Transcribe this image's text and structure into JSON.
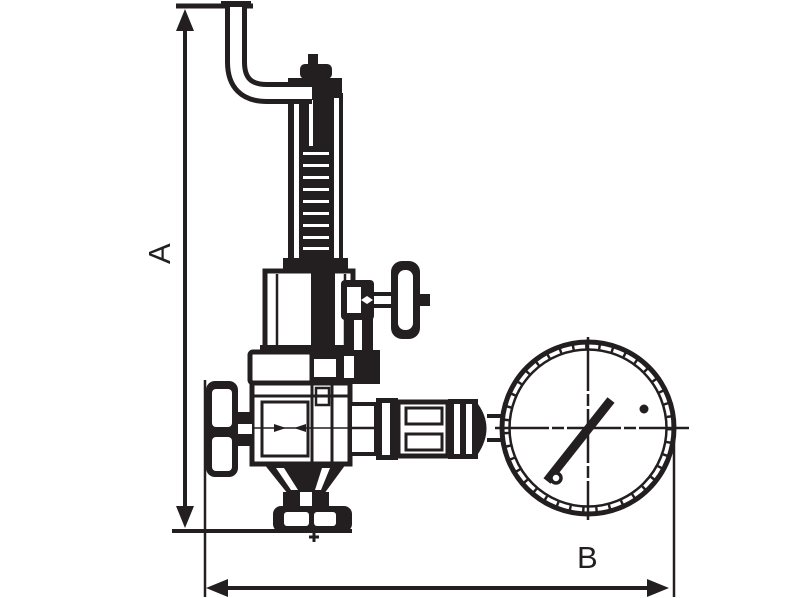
{
  "meta": {
    "background": "#ffffff",
    "line_color": "#231f20",
    "drawing_kind": "dimensioned technical line drawing of a safety/reducing valve with pressure gauge"
  },
  "dimensions": {
    "vertical_label": "A",
    "horizontal_label": "B"
  },
  "components": [
    "dimension-a-line",
    "dimension-b-line",
    "inlet-pipe",
    "adjustment-cap",
    "spring-housing",
    "spring-chamber",
    "test-valve-t-handle",
    "body-top-flange",
    "valve-body",
    "handwheel",
    "outlet-funnel",
    "bottom-flange",
    "gauge-connector",
    "pressure-gauge",
    "gauge-needle"
  ]
}
